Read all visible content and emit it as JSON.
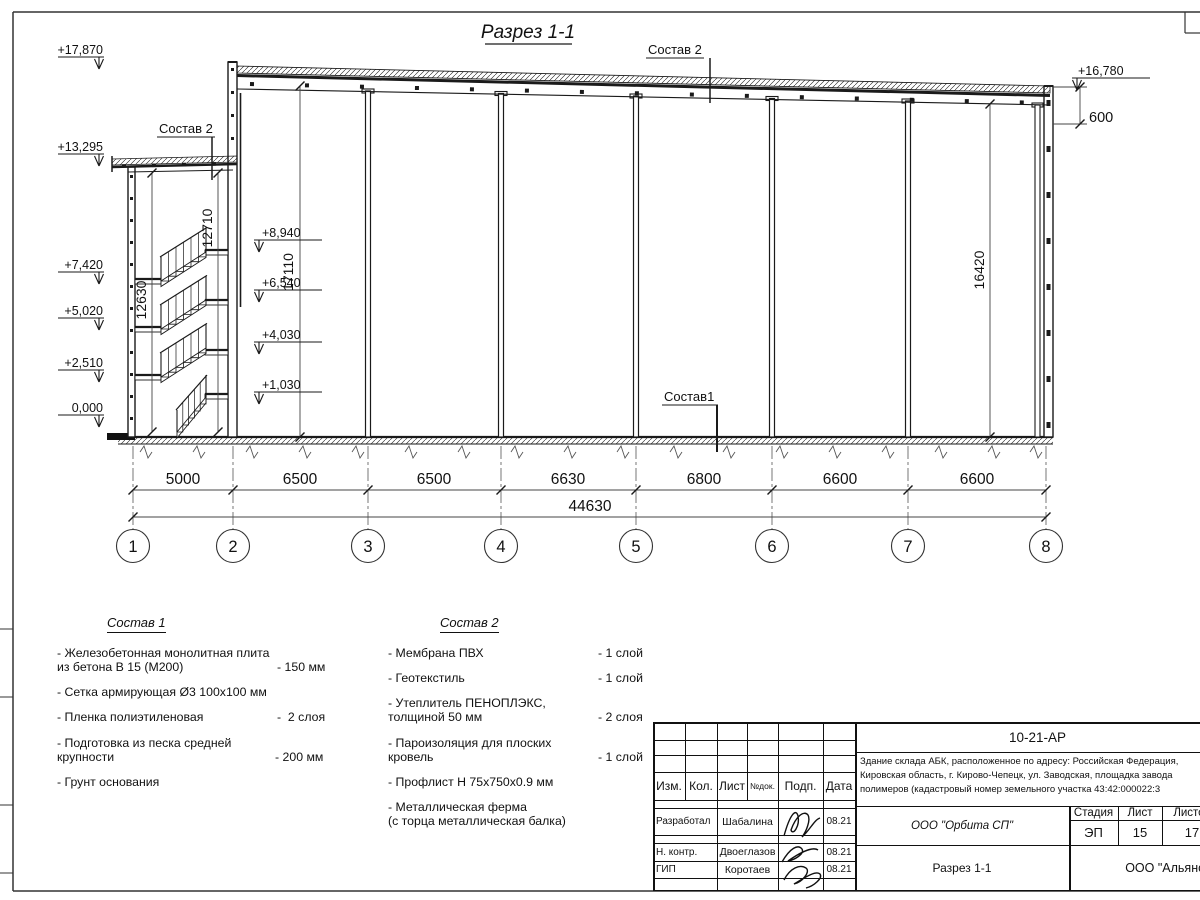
{
  "section": {
    "title": "Разрез 1-1",
    "labels": {
      "sostav1": "Состав1",
      "sostav2_roof": "Состав 2",
      "sostav2_abk": "Состав 2"
    },
    "elevations_left": [
      "+17,870",
      "+13,295",
      "+7,420",
      "+5,020",
      "+2,510",
      "0,000"
    ],
    "elevations_mid": [
      "+8,940",
      "+6,540",
      "+4,030",
      "+1,030"
    ],
    "elevation_right": "+16,780",
    "parapet_dim": "600",
    "vertical_dims": {
      "abk_left": "12630",
      "abk_right": "12710",
      "hall_left": "17110",
      "hall_right": "16420"
    },
    "axis_dims": [
      "5000",
      "6500",
      "6500",
      "6630",
      "6800",
      "6600",
      "6600"
    ],
    "total_dim": "44630",
    "axes": [
      "1",
      "2",
      "3",
      "4",
      "5",
      "6",
      "7",
      "8"
    ]
  },
  "legend1": {
    "title": "Состав 1",
    "items": [
      {
        "name": "- Железобетонная  монолитная плита\nиз бетона В 15 (М200)",
        "value": "- 150 мм"
      },
      {
        "name": "- Сетка армирующая Ø3 100х100 мм",
        "value": ""
      },
      {
        "name": "- Пленка полиэтиленовая",
        "value": "-  2 слоя"
      },
      {
        "name": "- Подготовка из песка средней\nкрупности",
        "value": "- 200 мм"
      },
      {
        "name": "- Грунт основания",
        "value": ""
      }
    ]
  },
  "legend2": {
    "title": "Состав 2",
    "items": [
      {
        "name": "- Мембрана ПВХ",
        "value": "- 1 слой"
      },
      {
        "name": "- Геотекстиль",
        "value": "- 1 слой"
      },
      {
        "name": "- Утеплитель ПЕНОПЛЭКС,\nтолщиной 50 мм",
        "value": "- 2 слоя"
      },
      {
        "name": "- Пароизоляция для плоских кровель",
        "value": "- 1 слой"
      },
      {
        "name": "- Профлист Н 75х750х0.9 мм",
        "value": ""
      },
      {
        "name": "- Металлическая ферма\n(с торца металлическая балка)",
        "value": ""
      }
    ]
  },
  "titleblock": {
    "doc_number": "10-21-АР",
    "description": "Здание склада АБК, расположенное по адресу: Российская Федерация,\nКировская область, г. Кирово-Чепецк, ул. Заводская, площадка завода\nполимеров (кадастровый номер земельного участка 43:42:000022:3",
    "header": {
      "izm": "Изм.",
      "kol": "Кол.",
      "list": "Лист",
      "ndok": "№док.",
      "podp": "Подп.",
      "data": "Дата"
    },
    "rows": [
      {
        "role": "Разработал",
        "name": "Шабалина",
        "date": "08.21"
      },
      {
        "role": "Н. контр.",
        "name": "Двоеглазов",
        "date": "08.21"
      },
      {
        "role": "ГИП",
        "name": "Коротаев",
        "date": "08.21"
      }
    ],
    "org": "ООО \"Орбита СП\"",
    "stage_label": "Стадия",
    "sheet_label": "Лист",
    "sheets_label": "Листов",
    "stage": "ЭП",
    "sheet": "15",
    "sheets": "17",
    "drawing_name": "Разрез 1-1",
    "company": "ООО \"Альянс\""
  }
}
